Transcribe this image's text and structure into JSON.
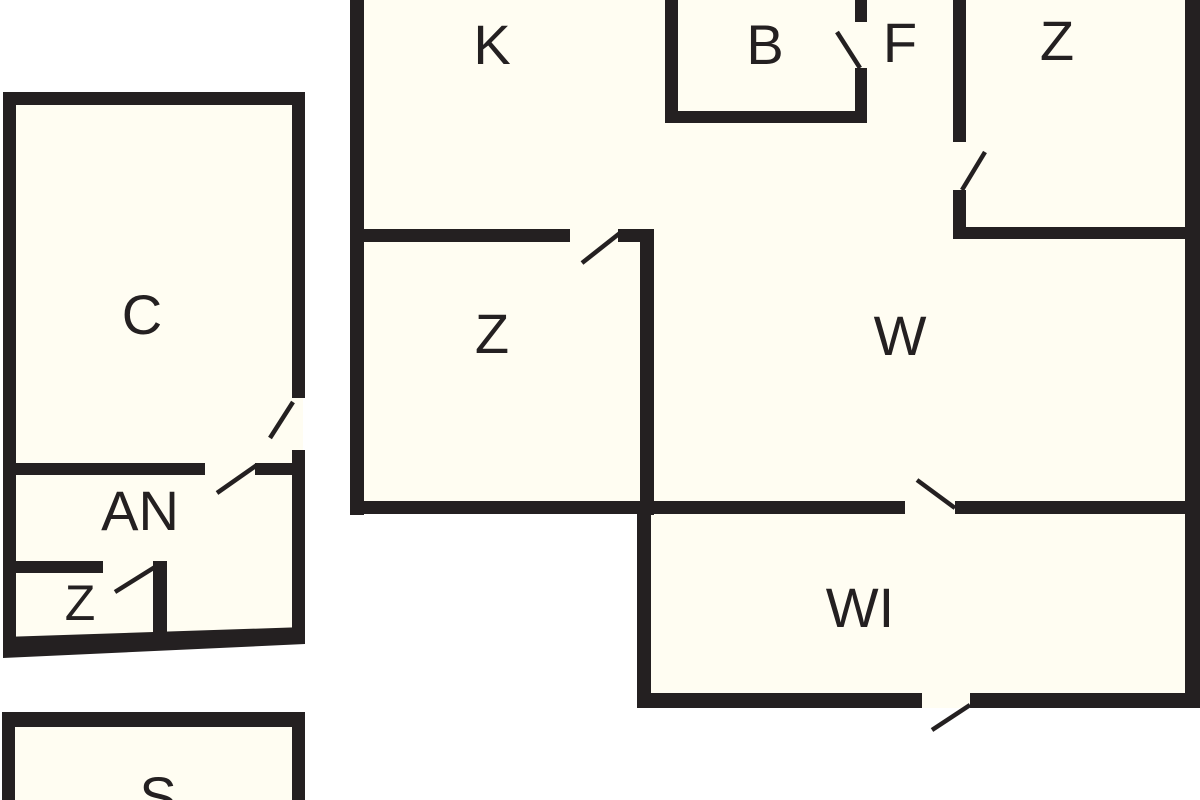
{
  "colors": {
    "wall": "#242021",
    "background": "#ffffff",
    "floor": "#fffdf2",
    "label": "#242021"
  },
  "buildings": {
    "main_house": {
      "rooms": {
        "k": "K",
        "b": "B",
        "f": "F",
        "z_top": "Z",
        "z_middle": "Z",
        "w": "W",
        "wi": "WI"
      }
    },
    "annex": {
      "rooms": {
        "c": "C",
        "an": "AN",
        "z_small": "Z"
      }
    },
    "shed": {
      "rooms": {
        "s": "S"
      }
    }
  }
}
